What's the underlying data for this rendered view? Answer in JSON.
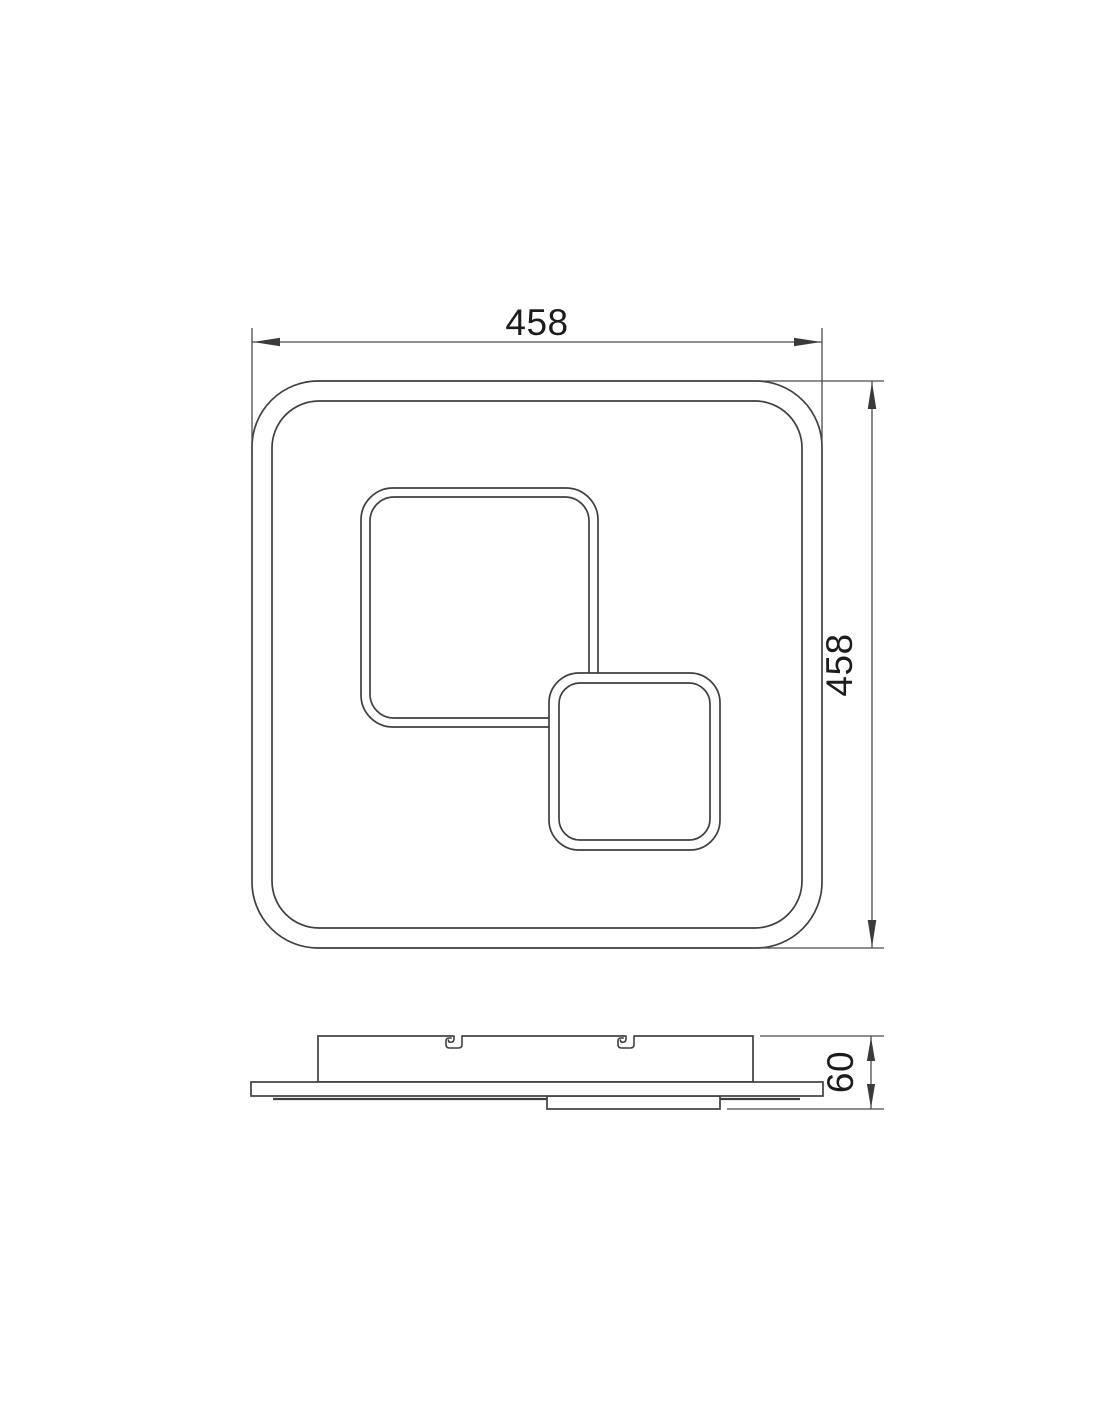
{
  "drawing": {
    "background_color": "#ffffff",
    "line_color": "#3f3f3f",
    "text_color": "#1c1c1c",
    "top_view": {
      "width_dim": {
        "value": "458"
      },
      "height_dim": {
        "value": "458"
      }
    },
    "side_view": {
      "depth_dim": {
        "value": "60"
      }
    }
  }
}
